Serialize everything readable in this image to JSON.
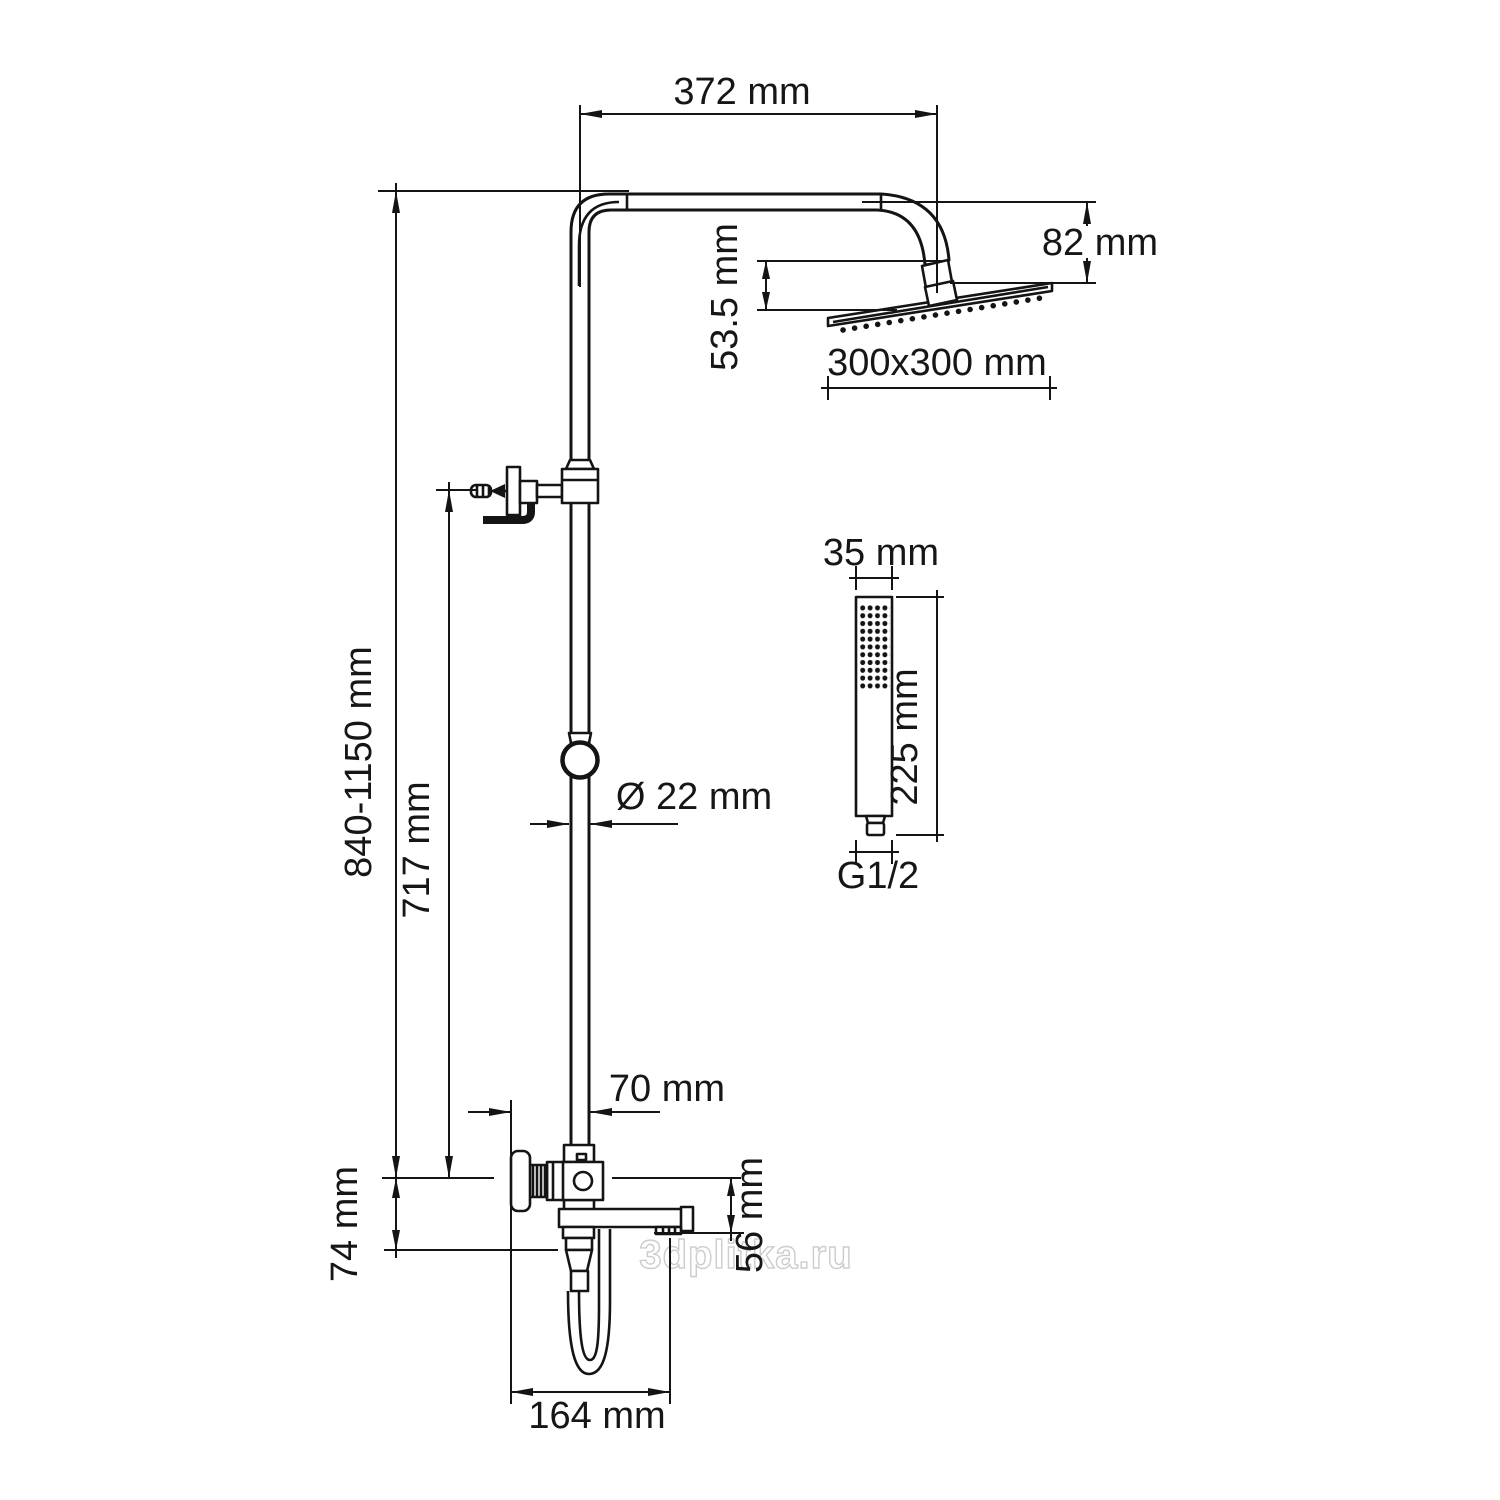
{
  "diagram": {
    "subject": "shower-column-technical-drawing",
    "units": "mm",
    "labels": {
      "arm_width": "372 mm",
      "head_drop": "82 mm",
      "head_tilt_drop": "53.5 mm",
      "head_size": "300x300 mm",
      "handshower_width": "35 mm",
      "handshower_length": "225 mm",
      "handshower_thread": "G1/2",
      "pipe_diameter": "Ø 22 mm",
      "column_height": "840-1150 mm",
      "bracket_to_mixer": "717 mm",
      "pipe_to_body_offset": "70 mm",
      "mixer_body_height": "74 mm",
      "spout_drop": "56 mm",
      "spout_reach": "164 mm"
    },
    "colors": {
      "line": "#141414",
      "background": "#ffffff",
      "watermark_stroke": "#cccccc",
      "watermark_fill": "#ffffff"
    }
  },
  "watermark": {
    "text": "3dplitka.ru"
  }
}
